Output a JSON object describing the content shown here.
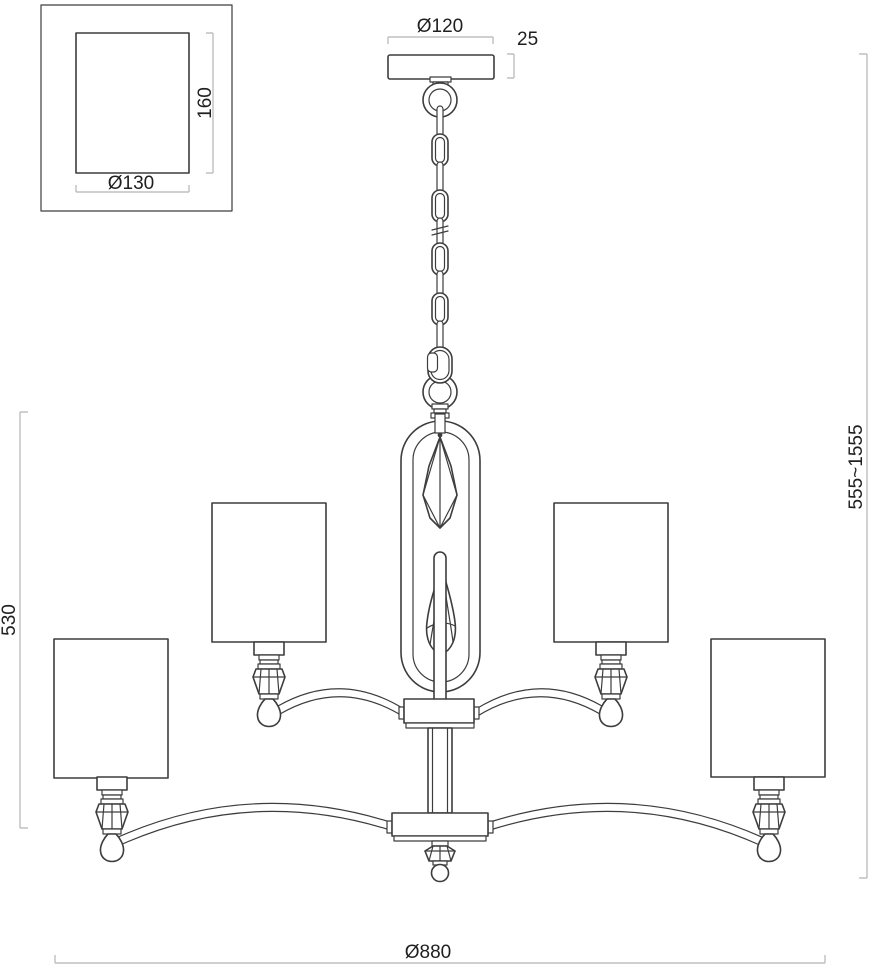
{
  "title": "Chandelier installation dimension drawing",
  "labels": {
    "ceiling_plate_diameter": "Ø120",
    "ceiling_plate_thickness": "25",
    "shade_detail": {
      "height": "160",
      "diameter": "Ø130"
    },
    "fixture_body_height": "530",
    "overall_height_range": "555~1555",
    "overall_diameter": "Ø880"
  },
  "colors": {
    "background": "#ffffff",
    "drawing_line": "#3d3d3d",
    "dimension_line": "#b4b4b4",
    "text": "#1f1f1f"
  }
}
